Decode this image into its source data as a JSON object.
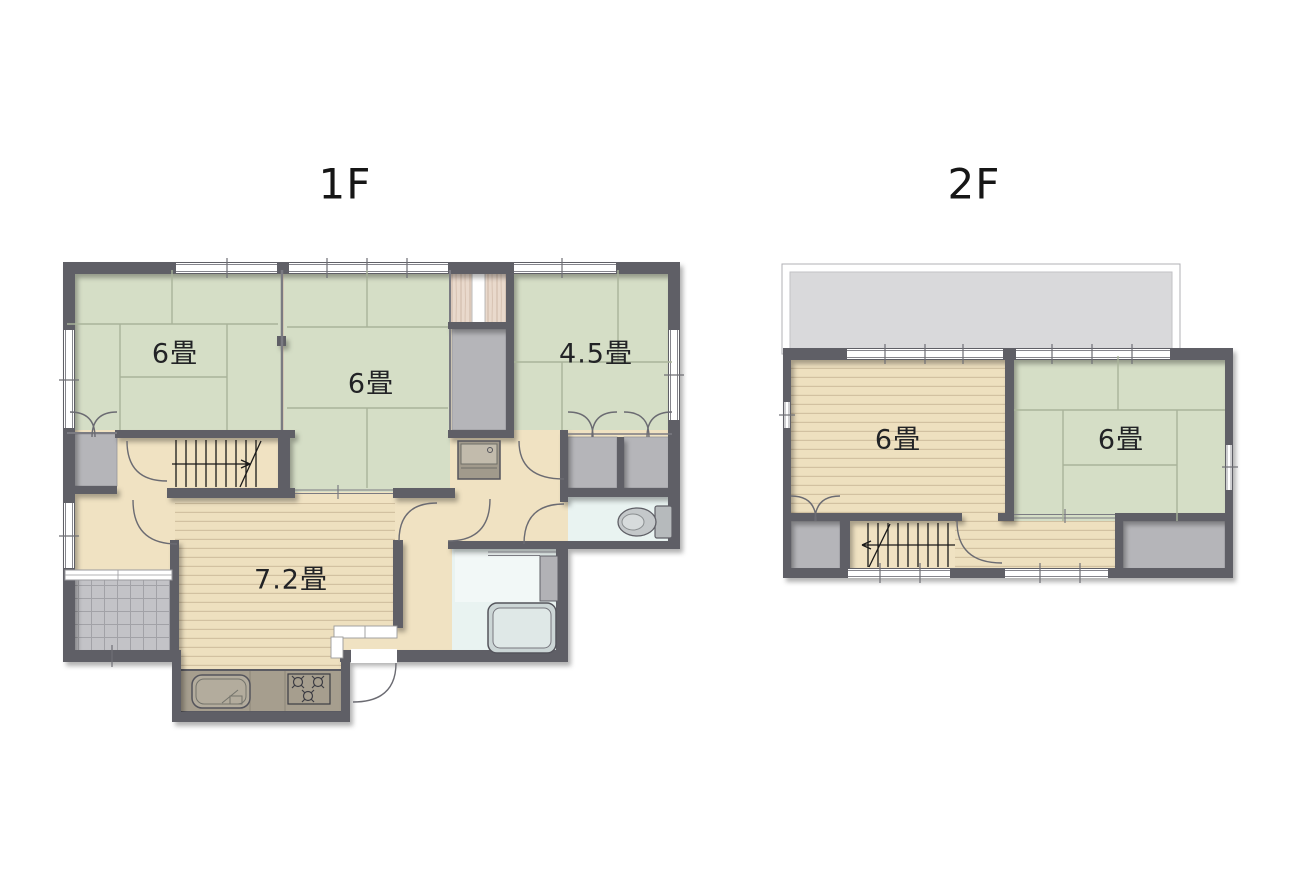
{
  "floors": [
    {
      "title": "1F",
      "rooms": [
        {
          "name": "tatami-room-nw",
          "label": "6畳"
        },
        {
          "name": "tatami-room-center",
          "label": "6畳"
        },
        {
          "name": "tatami-room-ne",
          "label": "4.5畳"
        },
        {
          "name": "dining-kitchen",
          "label": "7.2畳"
        }
      ],
      "fixtures": [
        "staircase",
        "genkan-tile-entrance",
        "kitchen-sink",
        "gas-stove",
        "washstand",
        "bathtub",
        "toilet",
        "closets"
      ]
    },
    {
      "title": "2F",
      "rooms": [
        {
          "name": "western-room",
          "label": "6畳"
        },
        {
          "name": "tatami-room",
          "label": "6畳"
        }
      ],
      "fixtures": [
        "balcony",
        "staircase",
        "closets",
        "wood-hallway"
      ]
    }
  ],
  "colors": {
    "tatami": "#d5dec6",
    "tatami_line": "#a9b39a",
    "wood_floor": "#eee0bf",
    "wood_line": "#d2c1a1",
    "hallway": "#f0e2c2",
    "wall": "#5f5f66",
    "closet": "#b5b5b9",
    "water_room": "#e9f3f1",
    "balcony": "#d9d9db",
    "entry_tile": "#c3c3c7",
    "counter": "#a69e8e",
    "wood_grain": "#e9d9cc"
  }
}
